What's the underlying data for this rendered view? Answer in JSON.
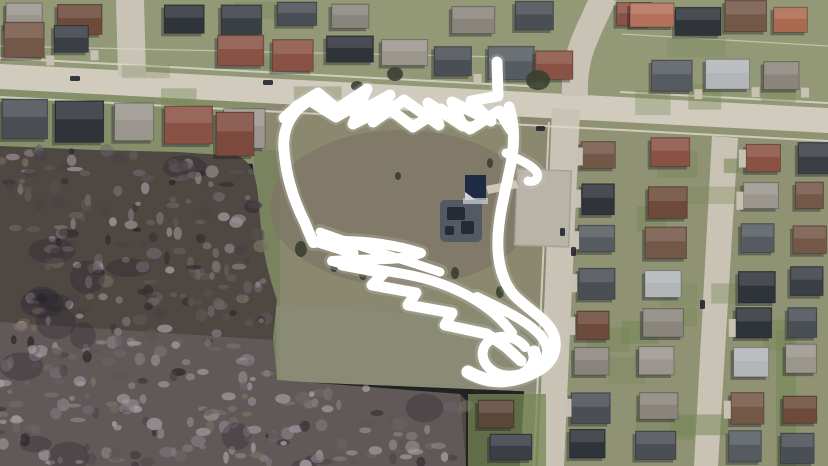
{
  "scene": {
    "kind": "aerial-satellite-photo",
    "description": "Aerial satellite view of a suburban neighborhood: a dark leafless wooded lot at lower left, an open tan-green park field in the center with a small playground, picnic pavilion and concrete pad, streets with rows of houses above and to the right, and a thick white hand-drawn marker scribble circling the park field with a tail at the top and a scribbled point at the lower right.",
    "annotation": {
      "tool": "freehand-marker-scribble",
      "color": "#ffffff",
      "halo_color": "#cfccc2",
      "paths": [
        "M497,62 L498,96 L471,101 L491,121 L452,102 L463,126 L428,103 L439,125 L404,100 L373,122 L390,95 L355,114 L367,89 L337,109 L318,93 L297,106 L284,118",
        "M309,100 L336,117 L363,101 L353,124 L387,107 L413,127 L441,109 L470,129 L499,111 L511,130",
        "M314,98 C291,109 282,129 284,150 C286,177 294,201 305,223 L312,240 L353,253 L342,265 L384,273 L372,285 L416,293 L408,305 L452,313 L445,325 L487,334 L506,347 L521,361",
        "M313,243 C347,238 391,243 421,253 C401,262 362,258 332,261 C362,269 401,271 433,281 C470,293 496,311 512,333",
        "M509,107 C517,131 513,156 509,173 C504,197 499,215 498,237 C497,259 501,279 513,294 C527,309 544,317 552,331 C558,343 556,357 544,367 C530,377 511,383 497,381",
        "M477,297 C497,307 521,317 537,332 C549,343 551,357 539,366 C525,376 505,379 493,371 C481,363 479,349 489,341 C501,333 517,337 525,347",
        "M506,153 C517,159 529,163 536,171 C540,177 536,183 528,181",
        "M468,372 C482,380 500,384 516,378 C530,373 538,362 534,352",
        "M320,232 C360,247 402,259 440,272"
      ]
    }
  },
  "colors": {
    "ground_top": "#939877",
    "ground_right": "#8f9374",
    "ground_left_yards": "#85906a",
    "woods_base": "#4e4742",
    "woods_lower": "#736c6d",
    "field": "#8b8870",
    "field_dry": "#7d7565",
    "field_south": "#8a8c74",
    "green_strip": "#6e7f52",
    "road": "#d1cbbe",
    "street": "#c9c3b5",
    "sidewalk": "#ded9cc",
    "pad": "#b9b4a8",
    "pad_border": "#a8a294",
    "playground": "#535a63",
    "playground_dark": "#262b33",
    "pavilion": "#1f2a45",
    "pavilion_light": "#ced2d6",
    "tree_dark": "#3a4031",
    "shadow": "#1c1e24",
    "car_dark": "#23262c",
    "lawn_green": "#778757",
    "driveway": "#c6c1b2",
    "roof_palette": [
      "#3a3e45",
      "#565b61",
      "#6d4a3a",
      "#8a5244",
      "#aa6a50",
      "#b2b6b9",
      "#9a958d",
      "#4a4f56",
      "#735747",
      "#2f333a",
      "#8a857c"
    ]
  }
}
